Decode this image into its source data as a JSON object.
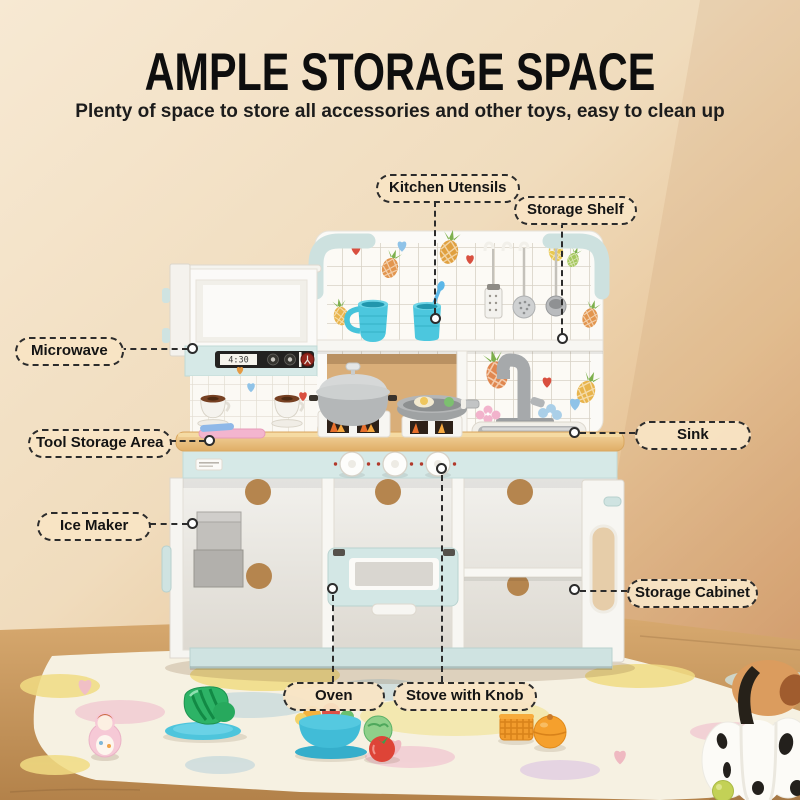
{
  "header": {
    "title": "AMPLE STORAGE SPACE",
    "subtitle": "Plenty of space to store all accessories and other toys, easy to clean up"
  },
  "callouts": [
    {
      "id": "kitchen-utensils",
      "label": "Kitchen Utensils"
    },
    {
      "id": "storage-shelf",
      "label": "Storage Shelf"
    },
    {
      "id": "microwave",
      "label": "Microwave"
    },
    {
      "id": "tool-storage-area",
      "label": "Tool Storage Area"
    },
    {
      "id": "ice-maker",
      "label": "Ice Maker"
    },
    {
      "id": "sink",
      "label": "Sink"
    },
    {
      "id": "storage-cabinet",
      "label": "Storage Cabinet"
    },
    {
      "id": "oven",
      "label": "Oven"
    },
    {
      "id": "stove-with-knob",
      "label": "Stove with Knob"
    }
  ],
  "kitchen": {
    "microwave_display": "4:30"
  },
  "colors": {
    "wall": "#f2e0c5",
    "mint_accent": "#d2e6e4",
    "counter_wood": "#e8c187",
    "callout_bg": "#f8e4c3",
    "callout_border": "#2c2c2c"
  }
}
